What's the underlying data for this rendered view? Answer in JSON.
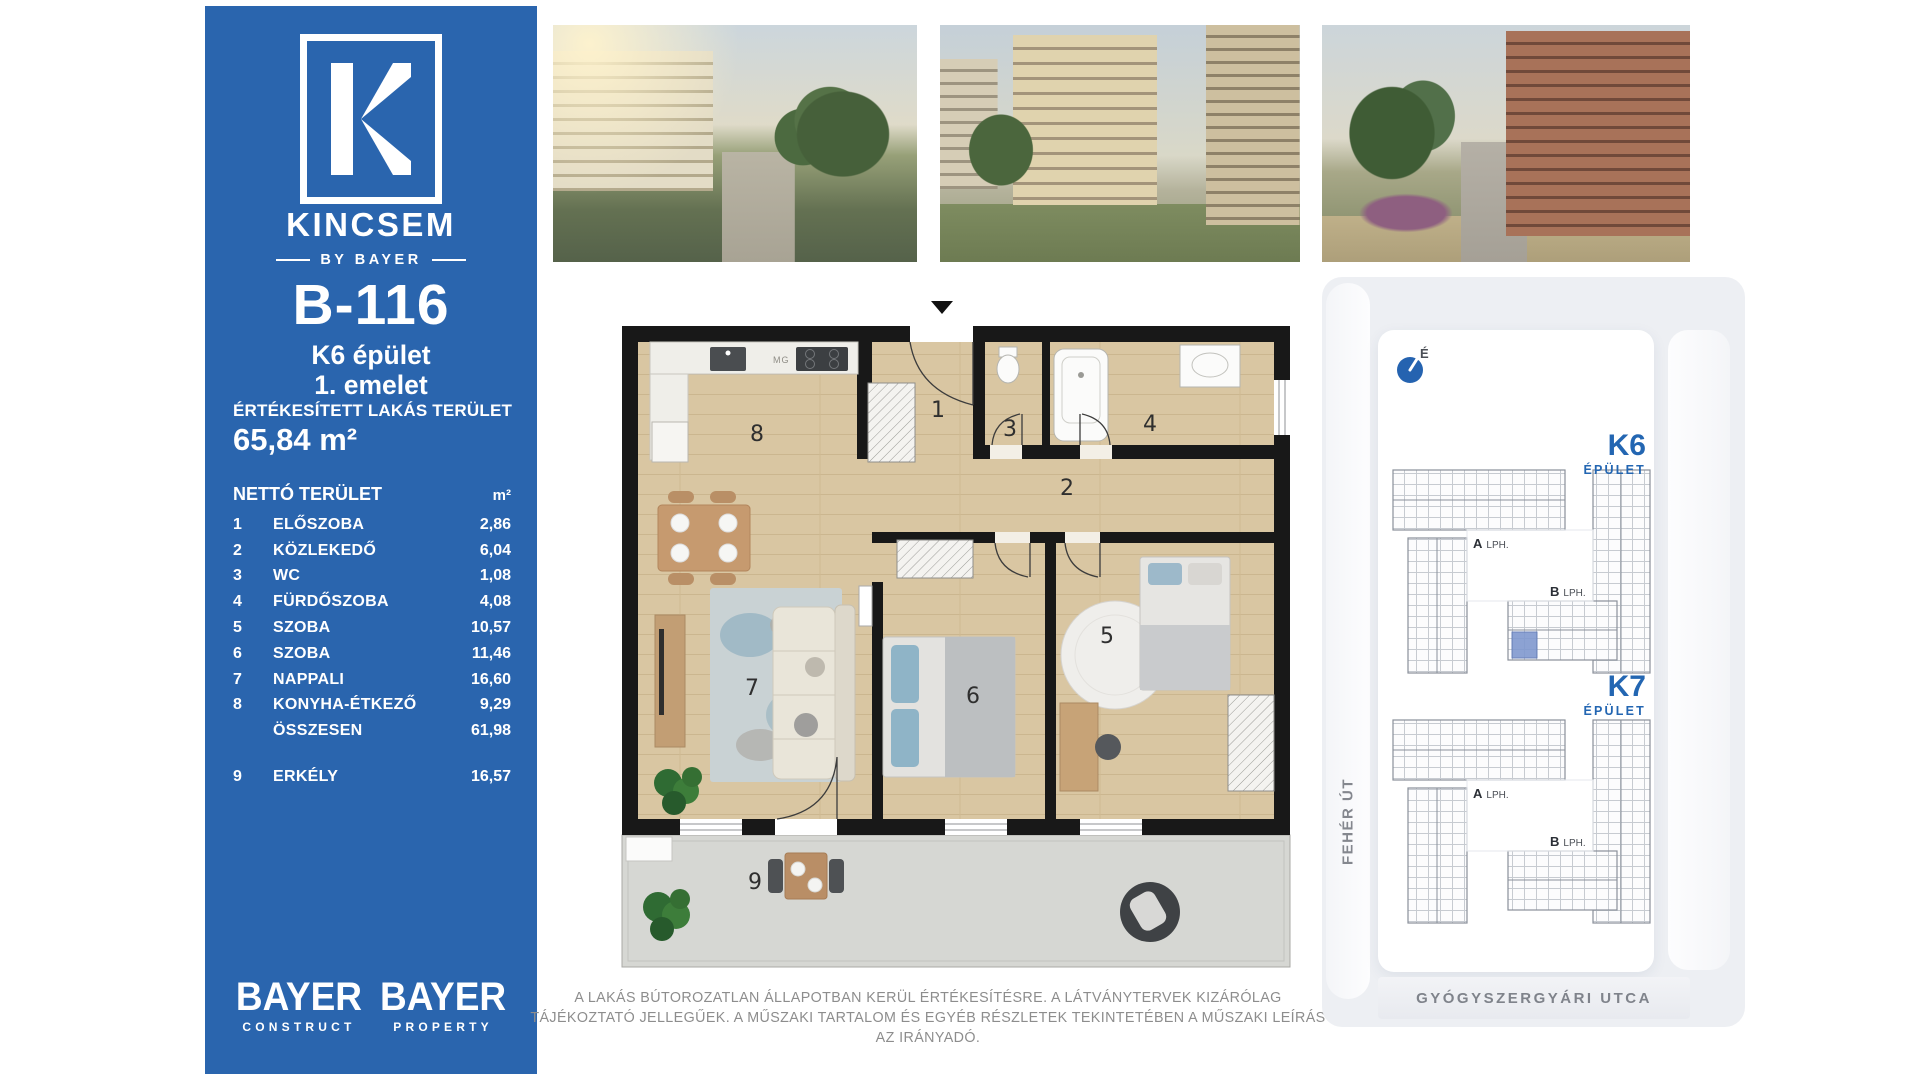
{
  "brand": {
    "logo_letter": "K",
    "name": "KINCSEM",
    "byline": "BY BAYER"
  },
  "unit": {
    "id": "B-116",
    "building": "K6 épület",
    "floor": "1. emelet"
  },
  "sold_area": {
    "label": "ÉRTÉKESÍTETT LAKÁS TERÜLET",
    "value": "65,84 m²"
  },
  "net_area": {
    "label": "NETTÓ TERÜLET",
    "unit_header": "m²",
    "rows": [
      {
        "num": "1",
        "name": "ELŐSZOBA",
        "value": "2,86"
      },
      {
        "num": "2",
        "name": "KÖZLEKEDŐ",
        "value": "6,04"
      },
      {
        "num": "3",
        "name": "WC",
        "value": "1,08"
      },
      {
        "num": "4",
        "name": "FÜRDŐSZOBA",
        "value": "4,08"
      },
      {
        "num": "5",
        "name": "SZOBA",
        "value": "10,57"
      },
      {
        "num": "6",
        "name": "SZOBA",
        "value": "11,46"
      },
      {
        "num": "7",
        "name": "NAPPALI",
        "value": "16,60"
      },
      {
        "num": "8",
        "name": "KONYHA-ÉTKEZŐ",
        "value": "9,29"
      },
      {
        "num": "",
        "name": "ÖSSZESEN",
        "value": "61,98"
      }
    ],
    "balcony_row": {
      "num": "9",
      "name": "ERKÉLY",
      "value": "16,57"
    }
  },
  "footer_logos": [
    {
      "title": "BAYER",
      "subtitle": "CONSTRUCT"
    },
    {
      "title": "BAYER",
      "subtitle": "PROPERTY"
    }
  ],
  "disclaimer": "A LAKÁS BÚTOROZATLAN ÁLLAPOTBAN KERÜL ÉRTÉKESÍTÉSRE. A LÁTVÁNYTERVEK KIZÁRÓLAG TÁJÉKOZTATÓ JELLEGŰEK. A MŰSZAKI TARTALOM ÉS EGYÉB RÉSZLETEK TEKINTETÉBEN A MŰSZAKI LEÍRÁS AZ IRÁNYADÓ.",
  "site_plan": {
    "compass_label": "É",
    "street_left": "FEHÉR ÚT",
    "street_bottom": "GYÓGYSZERGYÁRI UTCA",
    "buildings": [
      {
        "id": "K6",
        "type_label": "ÉPÜLET",
        "highlighted": true,
        "stairs": [
          {
            "letter": "A",
            "word": "LPH."
          },
          {
            "letter": "B",
            "word": "LPH."
          }
        ]
      },
      {
        "id": "K7",
        "type_label": "ÉPÜLET",
        "highlighted": false,
        "stairs": [
          {
            "letter": "A",
            "word": "LPH."
          },
          {
            "letter": "B",
            "word": "LPH."
          }
        ]
      }
    ]
  },
  "floor_plan": {
    "room_numbers": [
      "1",
      "2",
      "3",
      "4",
      "5",
      "6",
      "7",
      "8",
      "9"
    ],
    "kitchen_appliance_label": "MG"
  },
  "colors": {
    "sidebar_blue": "#2A65AE",
    "brand_blue": "#2366B2",
    "highlight_unit": "#8099CF"
  }
}
